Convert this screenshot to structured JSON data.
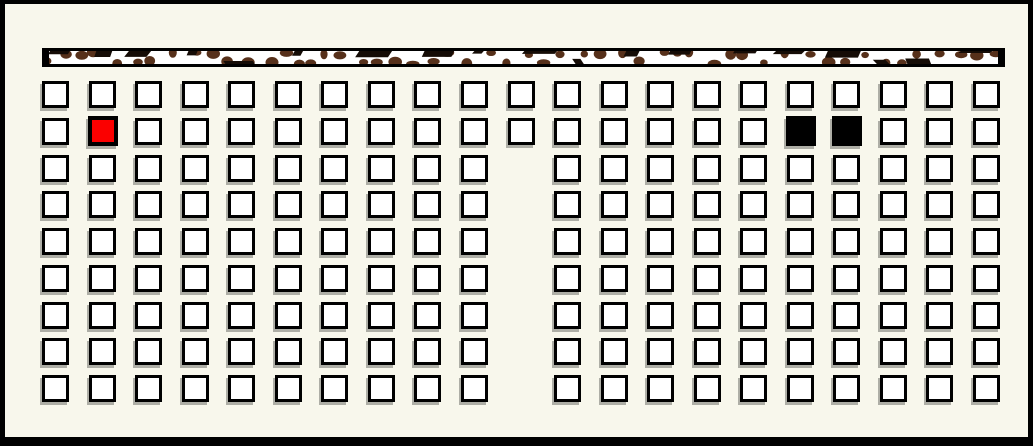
{
  "window": {
    "description": "grid of selectable square cells below a speckled horizontal bar",
    "background_color": "#f8f7ec",
    "frame_color": "#000000"
  },
  "top_bar": {
    "fill_color": "#ffffff",
    "border_color": "#000000",
    "speckle_brown_color": "#56301a",
    "speckle_black_color": "#150c06"
  },
  "grid": {
    "rows": 9,
    "cols": 21,
    "cell_fill": "#ffffff",
    "cell_border_color": "#000000",
    "cell_shadow_color": "#aeaea6",
    "aisle": {
      "col": 11,
      "missing_rows": [
        3,
        4,
        5,
        6,
        7,
        8,
        9
      ]
    },
    "marked_cells": [
      {
        "row": 2,
        "col": 2,
        "fill": "#fb0000",
        "name": "red-marked-cell"
      },
      {
        "row": 2,
        "col": 17,
        "fill": "#000000",
        "name": "black-marked-cell-1"
      },
      {
        "row": 2,
        "col": 18,
        "fill": "#000000",
        "name": "black-marked-cell-2"
      }
    ]
  }
}
